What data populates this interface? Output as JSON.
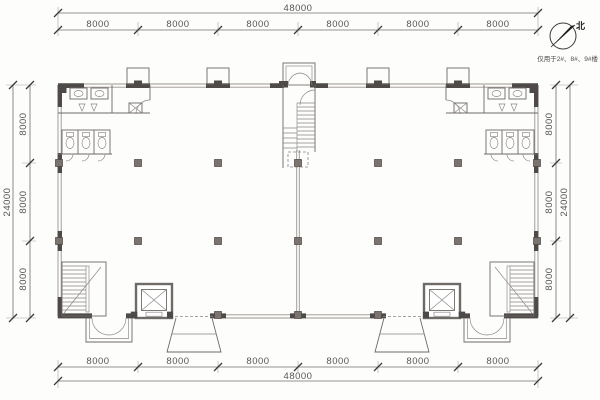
{
  "drawing": {
    "north_label": "北",
    "usage_note": "仅用于2#、8#、9#楼"
  },
  "dims": {
    "top": {
      "total": "48000",
      "segments": [
        "8000",
        "8000",
        "8000",
        "8000",
        "8000",
        "8000"
      ]
    },
    "bottom": {
      "total": "48000",
      "segments": [
        "8000",
        "8000",
        "8000",
        "8000",
        "8000",
        "8000"
      ]
    },
    "left": {
      "total": "24000",
      "segments": [
        "8000",
        "8000",
        "8000"
      ]
    },
    "right": {
      "total": "24000",
      "segments": [
        "8000",
        "8000",
        "8000"
      ]
    }
  }
}
